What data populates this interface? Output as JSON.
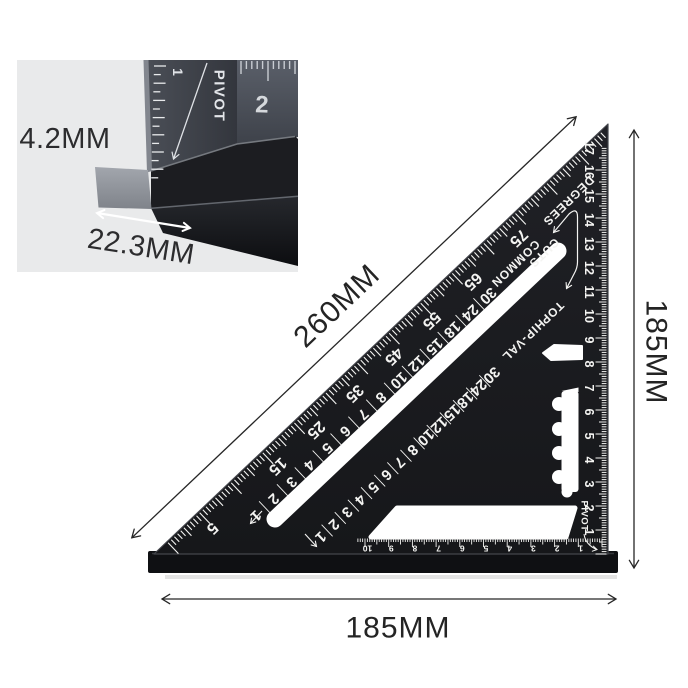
{
  "page": {
    "background": "#ffffff"
  },
  "inset": {
    "thickness_label": "4.2MM",
    "width_label": "22.3MM",
    "face_number": "2",
    "blade_number": "1",
    "pivot_text": "PIVOT",
    "background": "#e9eaeb"
  },
  "dimensions": {
    "hypotenuse_label": "260MM",
    "right_label": "185MM",
    "bottom_label": "185MM"
  },
  "square": {
    "labels": {
      "degrees": "DEGREES",
      "common": "COMMON",
      "cuts": "CUTS",
      "top": "TOP",
      "hip_val": "HIP-VAL",
      "pivot": "PIVOT"
    },
    "degree_values": [
      5,
      15,
      25,
      35,
      45,
      55,
      65,
      75
    ],
    "common_values": [
      30,
      24,
      18,
      15,
      12,
      10,
      8,
      7,
      6,
      5,
      4,
      3,
      2,
      1
    ],
    "hip_values": [
      30,
      24,
      18,
      15,
      12,
      10,
      8,
      7,
      6,
      5,
      4,
      3,
      2,
      1
    ],
    "right_scale_cm": [
      1,
      2,
      3,
      4,
      5,
      6,
      7,
      8,
      9,
      10,
      11,
      12,
      13,
      14,
      15,
      16,
      17
    ],
    "bottom_scale_cm": [
      1,
      2,
      3,
      4,
      5,
      6,
      7,
      8,
      9,
      10
    ],
    "colors": {
      "body": "#1a1b1e",
      "marks": "#f4f4f2",
      "lip": "#0f1013",
      "dimension": "#262626"
    }
  }
}
